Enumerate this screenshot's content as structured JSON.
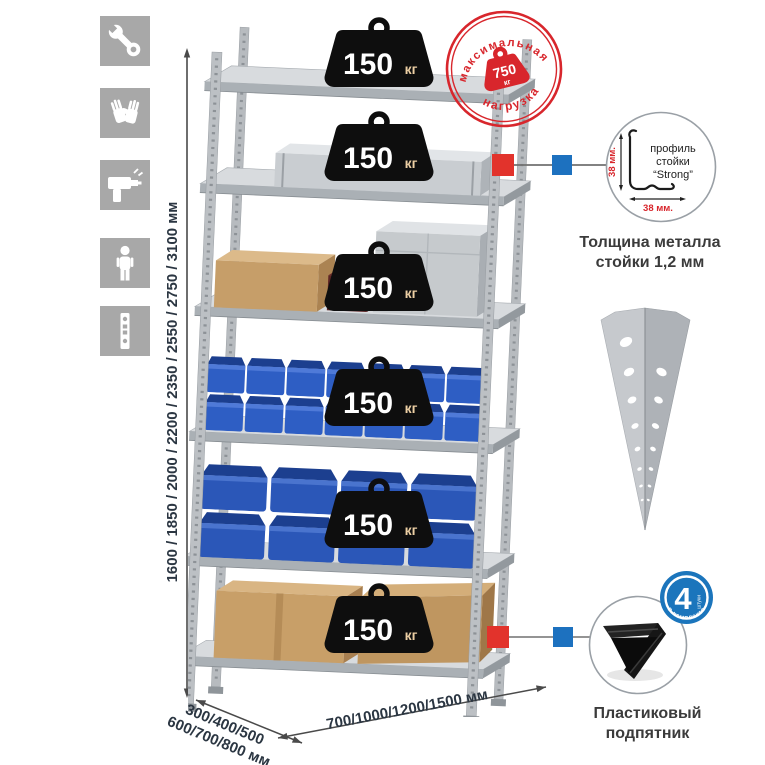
{
  "colors": {
    "accent_red": "#d8262c",
    "marker_red": "#e2332c",
    "marker_blue": "#1d71bf",
    "badge_black": "#0e0e0e",
    "bin_blue": "#2e5ec4",
    "metal_gray": "#c6cacd",
    "icon_tile_gray": "#a8a8a8",
    "dimension_text": "#2b3642"
  },
  "icons": [
    "wrench-icon",
    "gloves-icon",
    "drill-icon",
    "person-icon",
    "perforated-profile-icon"
  ],
  "dimensions": {
    "height": "1600 / 1850 / 2000 / 2200 / 2350 / 2550 / 2750 / 3100 мм",
    "depth_line1": "300/400/500",
    "depth_line2": "600/700/800 мм",
    "width": "700/1000/1200/1500 мм"
  },
  "shelf_badge": {
    "value": "150",
    "unit": "кг"
  },
  "max_load_stamp": {
    "arc_top": "максимальная",
    "arc_bottom": "нагрузка",
    "value": "750",
    "unit": "кг"
  },
  "profile_detail": {
    "label_line1": "профиль",
    "label_line2": "стойки",
    "label_line3": "“Strong”",
    "dim_vertical": "38 мм.",
    "dim_horizontal": "38 мм."
  },
  "thickness_caption": {
    "line1": "Толщина металла",
    "line2": "стойки 1,2 мм"
  },
  "foot_caption": {
    "line1": "Пластиковый",
    "line2": "подпятник"
  },
  "included_badge": {
    "count": "4",
    "count_suffix": "штуки",
    "arc": "в комплекте"
  }
}
